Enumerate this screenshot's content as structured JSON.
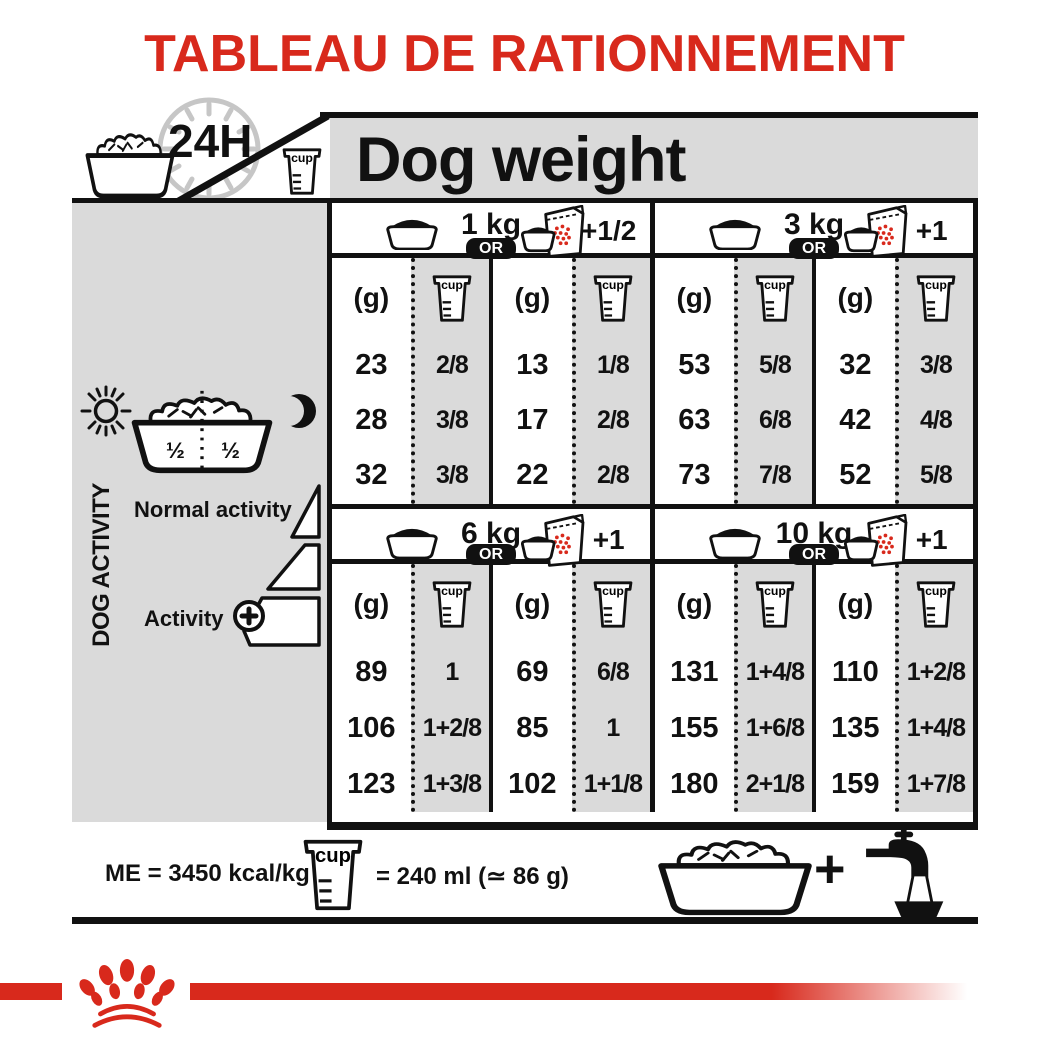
{
  "title": "TABLEAU DE RATIONNEMENT",
  "header": {
    "hours": "24H",
    "dog_weight": "Dog weight",
    "cup": "cup"
  },
  "sidebar": {
    "dog_activity": "DOG ACTIVITY",
    "half_left": "½",
    "half_right": "½",
    "normal_activity": "Normal activity",
    "activity": "Activity",
    "activity_plus": "+"
  },
  "table": {
    "or": "OR",
    "g": "(g)",
    "cup": "cup",
    "groups": [
      {
        "sections": [
          {
            "weight": "1 kg",
            "supplement": "+1/2",
            "bowl_only": {
              "g": [
                "23",
                "28",
                "32"
              ],
              "cup": [
                "2/8",
                "3/8",
                "3/8"
              ]
            },
            "bowl_plus": {
              "g": [
                "13",
                "17",
                "22"
              ],
              "cup": [
                "1/8",
                "2/8",
                "2/8"
              ]
            }
          },
          {
            "weight": "3 kg",
            "supplement": "+1",
            "bowl_only": {
              "g": [
                "53",
                "63",
                "73"
              ],
              "cup": [
                "5/8",
                "6/8",
                "7/8"
              ]
            },
            "bowl_plus": {
              "g": [
                "32",
                "42",
                "52"
              ],
              "cup": [
                "3/8",
                "4/8",
                "5/8"
              ]
            }
          }
        ]
      },
      {
        "sections": [
          {
            "weight": "6 kg",
            "supplement": "+1",
            "bowl_only": {
              "g": [
                "89",
                "106",
                "123"
              ],
              "cup": [
                "1",
                "1+2/8",
                "1+3/8"
              ]
            },
            "bowl_plus": {
              "g": [
                "69",
                "85",
                "102"
              ],
              "cup": [
                "6/8",
                "1",
                "1+1/8"
              ]
            }
          },
          {
            "weight": "10 kg",
            "supplement": "+1",
            "bowl_only": {
              "g": [
                "131",
                "155",
                "180"
              ],
              "cup": [
                "1+4/8",
                "1+6/8",
                "2+1/8"
              ]
            },
            "bowl_plus": {
              "g": [
                "110",
                "135",
                "159"
              ],
              "cup": [
                "1+2/8",
                "1+4/8",
                "1+7/8"
              ]
            }
          }
        ]
      }
    ]
  },
  "footer": {
    "me": "ME = 3450 kcal/kg",
    "cup": "cup",
    "cup_equiv": "= 240 ml (≃ 86 g)",
    "plus": "+"
  },
  "colors": {
    "red": "#d8291c",
    "panel_gray": "#dadada",
    "black": "#111111"
  }
}
